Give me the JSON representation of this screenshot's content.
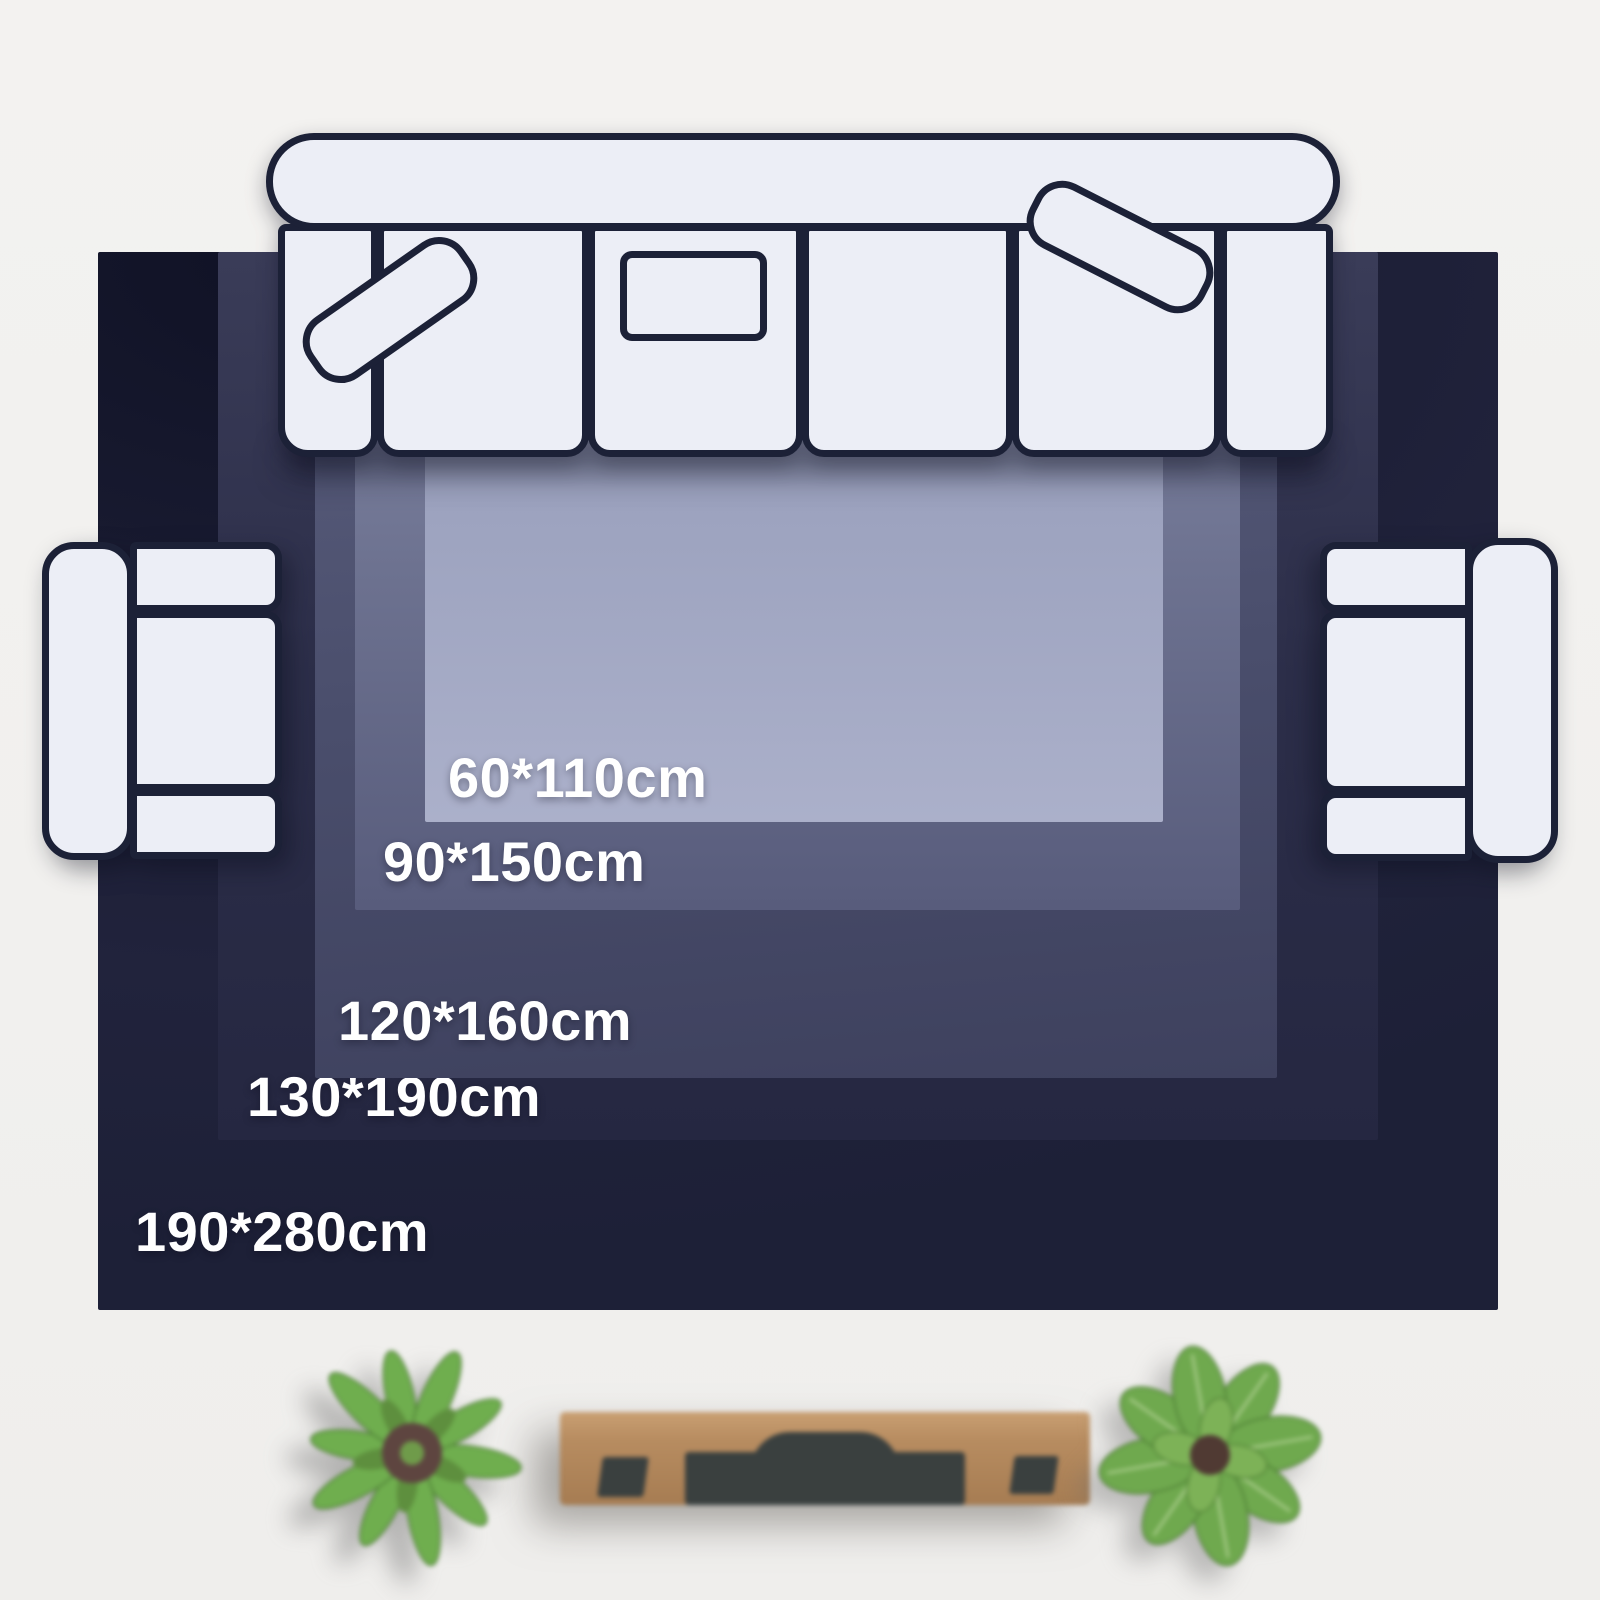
{
  "page": {
    "background_color": "#f2f1ef"
  },
  "rug": {
    "unit": "cm",
    "label_color": "#ffffff",
    "sizes": [
      {
        "label": "190*280cm",
        "width_cm": 190,
        "length_cm": 280,
        "surface_color": "#1d1f36"
      },
      {
        "label": "130*190cm",
        "width_cm": 130,
        "length_cm": 190,
        "surface_color": "#2c2e49"
      },
      {
        "label": "120*160cm",
        "width_cm": 120,
        "length_cm": 160,
        "surface_color": "#4a4e6c"
      },
      {
        "label": "90*150cm",
        "width_cm": 90,
        "length_cm": 150,
        "surface_color": "#6d7290"
      },
      {
        "label": "60*110cm",
        "width_cm": 60,
        "length_cm": 110,
        "surface_color": "#9ea4c0"
      }
    ]
  },
  "furniture_palette": {
    "cushion_fill": "#eceef6",
    "outline": "#1c2137",
    "console_wood": "#b2875d",
    "plant_green": "#6fae4e"
  }
}
